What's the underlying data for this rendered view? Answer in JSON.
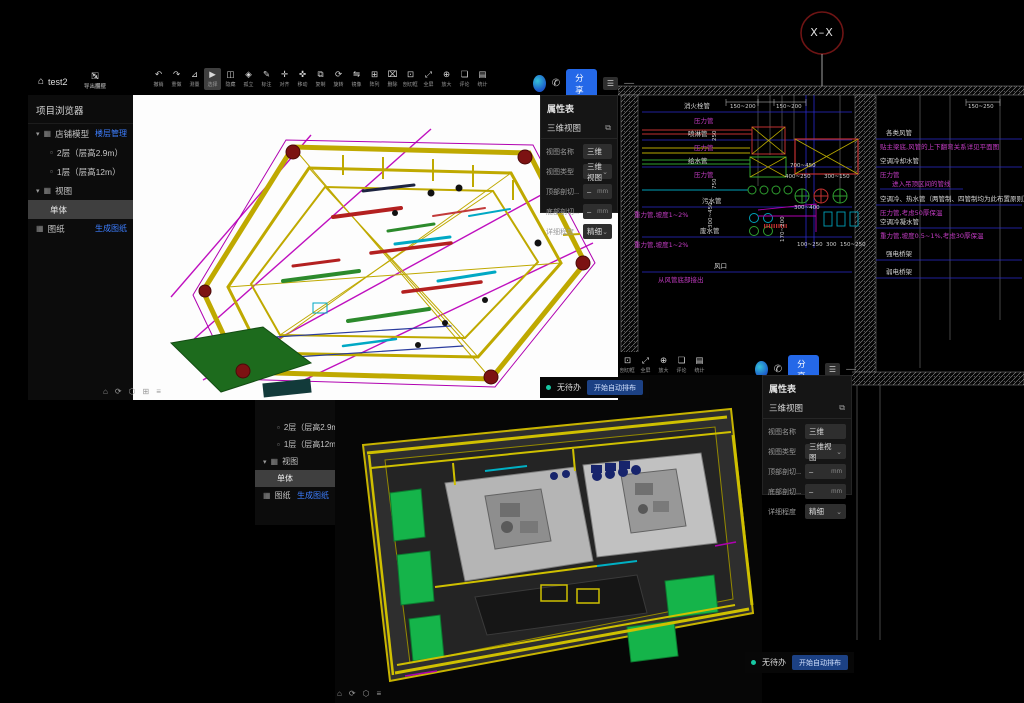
{
  "colors": {
    "accent_blue": "#2468e8",
    "link_blue": "#3d7eff",
    "status_teal": "#17c8a3",
    "cad_blue": "#2a2ace",
    "cad_magenta": "#c43cc4",
    "selection_gray": "#3f3f3f"
  },
  "win1": {
    "title": "test2",
    "home_icon": "⌂",
    "file_actions": [
      {
        "g": "⇲",
        "label": "导入图纸",
        "name": "import-drawing"
      },
      {
        "g": "⇱",
        "label": "导出模型",
        "name": "export-model"
      }
    ],
    "toolbar": [
      {
        "g": "↶",
        "label": "撤销",
        "name": "undo"
      },
      {
        "g": "↷",
        "label": "重做",
        "name": "redo"
      },
      {
        "g": "⊿",
        "label": "测量",
        "name": "measure"
      },
      {
        "g": "▶",
        "label": "选择",
        "name": "select",
        "active": true
      },
      {
        "g": "◫",
        "label": "隐藏",
        "name": "hide"
      },
      {
        "g": "◈",
        "label": "孤立",
        "name": "isolate"
      },
      {
        "g": "✎",
        "label": "标注",
        "name": "annotate"
      },
      {
        "g": "✛",
        "label": "对齐",
        "name": "align"
      },
      {
        "g": "✜",
        "label": "移动",
        "name": "move"
      },
      {
        "g": "⧉",
        "label": "复制",
        "name": "copy"
      },
      {
        "g": "⟳",
        "label": "旋转",
        "name": "rotate"
      },
      {
        "g": "⇋",
        "label": "镜像",
        "name": "mirror"
      },
      {
        "g": "⊞",
        "label": "阵列",
        "name": "array"
      },
      {
        "g": "⌧",
        "label": "删除",
        "name": "delete"
      },
      {
        "g": "⊡",
        "label": "剖切框",
        "name": "section-box"
      },
      {
        "g": "⤢",
        "label": "全屏",
        "name": "fullscreen"
      },
      {
        "g": "⊕",
        "label": "放大",
        "name": "zoom-in"
      },
      {
        "g": "❏",
        "label": "评论",
        "name": "comment"
      },
      {
        "g": "▤",
        "label": "统计",
        "name": "statistics"
      }
    ],
    "share": {
      "phone_icon": "✆",
      "share_label": "分享",
      "menu_icon": "☰",
      "more_icon": "—"
    },
    "browser": {
      "title": "项目浏览器",
      "items": [
        {
          "exp": "▾",
          "ic": "▦",
          "label": "店铺模型",
          "link": "楼层管理"
        },
        {
          "ic": "▫",
          "label": "2层（层高2.9m）",
          "level": 1
        },
        {
          "ic": "▫",
          "label": "1层（层高12m）",
          "level": 1
        },
        {
          "exp": "▾",
          "ic": "▦",
          "label": "视图"
        },
        {
          "label": "单体",
          "level": 1,
          "selected": true
        },
        {
          "ic": "▦",
          "label": "图纸",
          "link": "生成图纸"
        }
      ]
    },
    "view_icons": [
      "⌂",
      "⟳",
      "⬡",
      "⊞",
      "≡"
    ]
  },
  "win2": {
    "toolbar": [
      {
        "g": "⊡",
        "label": "剖切框",
        "name": "section-box"
      },
      {
        "g": "⤢",
        "label": "全屏",
        "name": "fullscreen"
      },
      {
        "g": "⊕",
        "label": "放大",
        "name": "zoom-in"
      },
      {
        "g": "❏",
        "label": "评论",
        "name": "comment"
      },
      {
        "g": "▤",
        "label": "统计",
        "name": "statistics"
      }
    ],
    "share": {
      "phone_icon": "✆",
      "share_label": "分享",
      "menu_icon": "☰",
      "more_icon": "—"
    },
    "sidebar": {
      "items": [
        {
          "ic": "▫",
          "label": "2层（层高2.9m）",
          "level": 1
        },
        {
          "ic": "▫",
          "label": "1层（层高12m）",
          "level": 1
        },
        {
          "exp": "▾",
          "ic": "▦",
          "label": "视图"
        },
        {
          "label": "单体",
          "level": 1,
          "selected": true
        },
        {
          "ic": "▦",
          "label": "图纸",
          "link": "生成图纸"
        }
      ]
    },
    "view_icons": [
      "⌂",
      "⟳",
      "⬡",
      "≡"
    ]
  },
  "propsheet": {
    "title": "属性表",
    "section": "三维视图",
    "section_icon": "⧉",
    "fields": [
      {
        "label": "视图名称",
        "value": "三维"
      },
      {
        "label": "视图类型",
        "value": "三维视图",
        "caret": "⌄"
      },
      {
        "label": "顶部剖切...",
        "value": "–",
        "suffix": "mm"
      },
      {
        "label": "底部剖切...",
        "value": "–",
        "suffix": "mm"
      },
      {
        "label": "详细程度",
        "value": "精细",
        "caret": "⌄"
      }
    ]
  },
  "status": {
    "badge": "无待办",
    "action": "开始自动排布"
  },
  "cad": {
    "axis_label": "X–X",
    "left_labels": [
      {
        "text": "消火栓管",
        "color": "w",
        "x": 66,
        "y": 100
      },
      {
        "text": "压力管",
        "color": "m",
        "x": 76,
        "y": 115
      },
      {
        "text": "喷淋管",
        "color": "w",
        "x": 70,
        "y": 128
      },
      {
        "text": "压力管",
        "color": "m",
        "x": 76,
        "y": 142
      },
      {
        "text": "给水管",
        "color": "w",
        "x": 70,
        "y": 155
      },
      {
        "text": "压力管",
        "color": "m",
        "x": 76,
        "y": 169
      },
      {
        "text": "污水管",
        "color": "w",
        "x": 84,
        "y": 195
      },
      {
        "text": "重力管,坡度1~2%",
        "color": "m",
        "x": 16,
        "y": 209
      },
      {
        "text": "废水管",
        "color": "w",
        "x": 82,
        "y": 225
      },
      {
        "text": "重力管,坡度1~2%",
        "color": "m",
        "x": 16,
        "y": 239
      },
      {
        "text": "风口",
        "color": "w",
        "x": 96,
        "y": 260
      },
      {
        "text": "从风管底部接出",
        "color": "m",
        "x": 40,
        "y": 274
      }
    ],
    "right_labels": [
      {
        "text": "各类风管",
        "color": "w",
        "x": 268,
        "y": 127
      },
      {
        "text": "贴主梁底,风管的上下翻弯关系详见平面图",
        "color": "m",
        "x": 262,
        "y": 141
      },
      {
        "text": "空调冷却水管",
        "color": "w",
        "x": 262,
        "y": 155
      },
      {
        "text": "压力管",
        "color": "m",
        "x": 262,
        "y": 169
      },
      {
        "text": "进入吊顶区间的管线",
        "color": "m",
        "x": 274,
        "y": 178
      },
      {
        "text": "空调冷、热水管（两管制、四管制均为此布置原则）",
        "color": "w",
        "x": 262,
        "y": 193
      },
      {
        "text": "压力管,考虑50厚保温",
        "color": "m",
        "x": 262,
        "y": 207
      },
      {
        "text": "空调冷凝水管",
        "color": "w",
        "x": 262,
        "y": 216
      },
      {
        "text": "重力管,坡度0.5~1%,考虑30厚保温",
        "color": "m",
        "x": 262,
        "y": 230
      },
      {
        "text": "强电桥架",
        "color": "w",
        "x": 268,
        "y": 248
      },
      {
        "text": "弱电桥架",
        "color": "w",
        "x": 268,
        "y": 266
      }
    ],
    "dimensions": [
      {
        "text": "150~200",
        "x": 112,
        "y": 104
      },
      {
        "text": "150~200",
        "x": 158,
        "y": 104
      },
      {
        "text": "150~250",
        "x": 350,
        "y": 104
      },
      {
        "text": "700~450",
        "x": 172,
        "y": 163
      },
      {
        "text": "400~250",
        "x": 167,
        "y": 174
      },
      {
        "text": "300~150",
        "x": 206,
        "y": 174
      },
      {
        "text": "300~400",
        "x": 176,
        "y": 205
      },
      {
        "text": "100~250",
        "x": 179,
        "y": 242
      },
      {
        "text": "300",
        "x": 208,
        "y": 242
      },
      {
        "text": "150~250",
        "x": 222,
        "y": 242
      }
    ],
    "rot_dims": [
      {
        "text": "250",
        "x": 100,
        "y": 135
      },
      {
        "text": "750",
        "x": 100,
        "y": 183
      },
      {
        "text": "300~450",
        "x": 96,
        "y": 222
      },
      {
        "text": "170~200",
        "x": 168,
        "y": 236
      }
    ]
  }
}
